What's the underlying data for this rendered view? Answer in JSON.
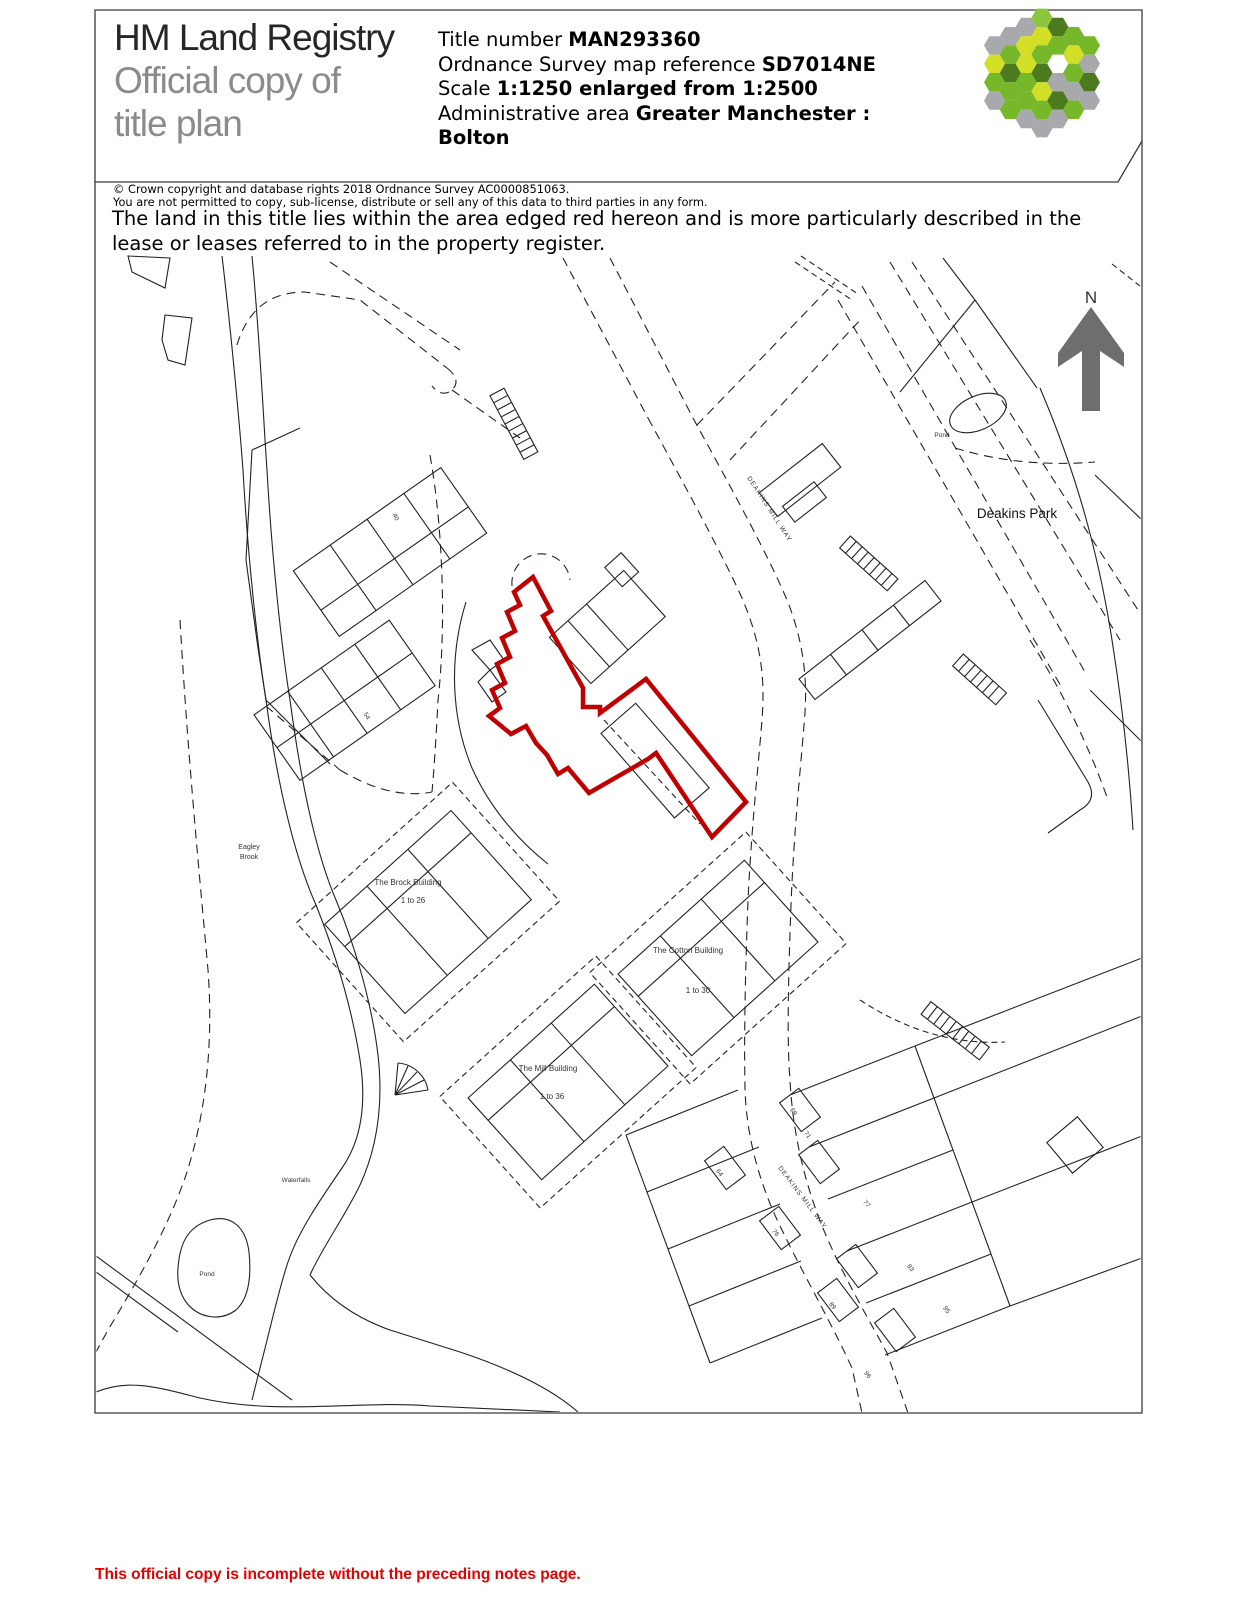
{
  "header": {
    "logo_line1": "HM Land Registry",
    "logo_line2": "Official copy of",
    "logo_line3": "title plan",
    "title_label": "Title number ",
    "title_value": "MAN293360",
    "os_label": "Ordnance Survey map reference ",
    "os_value": "SD7014NE",
    "scale_label": "Scale ",
    "scale_value": "1:1250 enlarged from 1:2500",
    "admin_label": "Administrative area ",
    "admin_value": "Greater Manchester :",
    "admin_value2": "Bolton"
  },
  "logo": {
    "palette": {
      "G": "#a7a9ac",
      "L": "#76b82a",
      "Y": "#d3de27",
      "D": "#4c7a1e",
      "M": "#8cc63e"
    },
    "columns": [
      "GYLG",
      "GLDLL",
      "GYYLLG",
      "MYLDYLG",
      "DL.GDG",
      "LYLGL",
      "LGDG"
    ]
  },
  "notices": {
    "copyright": "© Crown copyright and database rights 2018 Ordnance Survey AC0000851063.",
    "permission": "You are not permitted to copy, sub-license, distribute or sell any of this data to third parties in any form.",
    "statement": "The land in this title lies within the area edged red hereon and is more particularly described in the lease or leases referred to in the property register."
  },
  "map": {
    "north_label": "N",
    "park_label": "Deakins Park",
    "road_label": "DEAKINS MILL WAY",
    "pond_label_top": "Pond",
    "pond_label_bottom": "Pond",
    "brook_label_1": "Eagley",
    "brook_label_2": "Brook",
    "waterfalls_label": "Waterfalls",
    "buildings": [
      {
        "name": "The Brock Building",
        "units": "1 to 26"
      },
      {
        "name": "The Cotton Building",
        "units": "1 to 30"
      },
      {
        "name": "The Mill Building",
        "units": "1 to 36"
      }
    ],
    "plot_numbers": [
      "40",
      "54",
      "69",
      "71",
      "64",
      "77",
      "76",
      "83",
      "89",
      "95",
      "96"
    ],
    "red_edge_color": "#c00000",
    "north_arrow_color": "#6e6e6e"
  },
  "footer": {
    "warning": "This official copy is incomplete without the preceding notes page."
  }
}
